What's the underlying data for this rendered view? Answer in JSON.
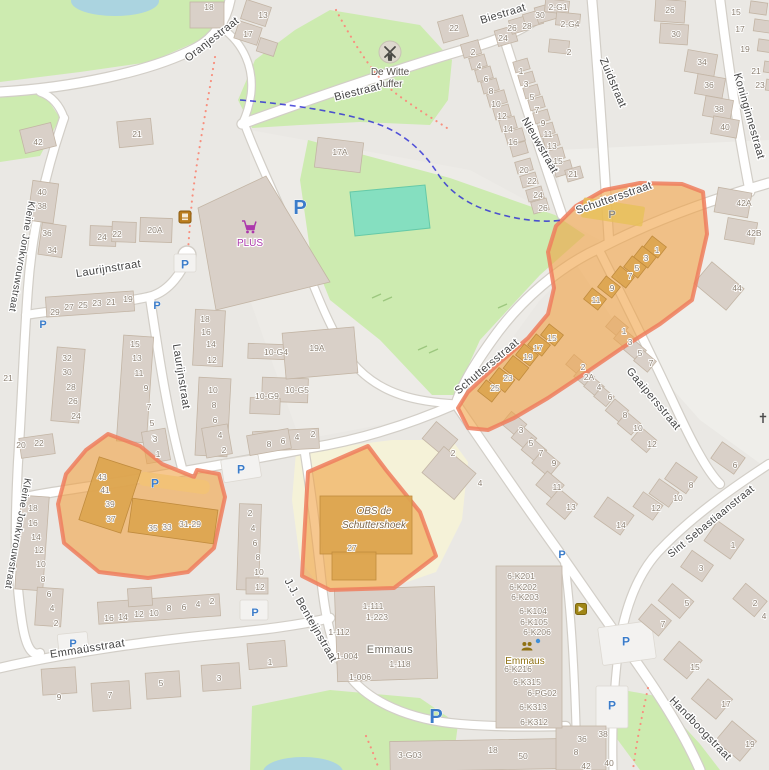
{
  "streets": [
    {
      "t": "Oranjestraat",
      "x": 214,
      "y": 42,
      "r": -38
    },
    {
      "t": "Biestraat",
      "x": 504,
      "y": 17,
      "r": -17
    },
    {
      "t": "Biestraat",
      "x": 358,
      "y": 95,
      "r": -14
    },
    {
      "t": "Nieuwstraat",
      "x": 537,
      "y": 147,
      "r": 60
    },
    {
      "t": "Zuidstraat",
      "x": 610,
      "y": 84,
      "r": 67
    },
    {
      "t": "Koninginnestraat",
      "x": 746,
      "y": 117,
      "r": 74
    },
    {
      "t": "Schuttersstraat",
      "x": 615,
      "y": 201,
      "r": -19
    },
    {
      "t": "Schuttersstraat",
      "x": 489,
      "y": 369,
      "r": -40
    },
    {
      "t": "Laurijnstraat",
      "x": 109,
      "y": 272,
      "r": -9
    },
    {
      "t": "Laurijnstraat",
      "x": 178,
      "y": 377,
      "r": 81
    },
    {
      "t": "Kleine Jonkvrouwstraat",
      "x": 19,
      "y": 256,
      "r": 100,
      "s": 10
    },
    {
      "t": "Kleine Jonkvrouwstraat",
      "x": 15,
      "y": 533,
      "r": 100,
      "s": 10
    },
    {
      "t": "Gaaipersstraat",
      "x": 651,
      "y": 401,
      "r": 50
    },
    {
      "t": "Sint Sebastiaanstraat",
      "x": 713,
      "y": 524,
      "r": -39,
      "s": 10.5
    },
    {
      "t": "Handboogstraat",
      "x": 698,
      "y": 731,
      "r": 46
    },
    {
      "t": "Emmaüsstraat",
      "x": 88,
      "y": 652,
      "r": -9
    },
    {
      "t": "J.J. Benteijnstraat",
      "x": 308,
      "y": 622,
      "r": 60
    }
  ],
  "pois": {
    "windmill": {
      "line1": "De Witte",
      "line2": "Juffer"
    },
    "supermarket": {
      "name": "PLUS"
    },
    "school": {
      "line1": "OBS de",
      "line2": "Schuttershoek"
    },
    "building_emmaus": {
      "name": "Emmaus"
    },
    "community_emmaus": {
      "name": "Emmaus"
    }
  },
  "parking_label": "P",
  "parking_markers": [
    [
      300,
      207,
      20
    ],
    [
      436,
      716,
      20
    ],
    [
      185,
      264,
      12
    ],
    [
      157,
      305,
      11
    ],
    [
      43,
      324,
      11
    ],
    [
      241,
      469,
      12
    ],
    [
      155,
      483,
      12
    ],
    [
      612,
      214,
      11,
      "gray"
    ],
    [
      562,
      554,
      11
    ],
    [
      626,
      641,
      12
    ],
    [
      612,
      705,
      12
    ],
    [
      73,
      643,
      11
    ],
    [
      255,
      612,
      11
    ]
  ],
  "house_numbers": [
    [
      "18",
      209,
      7
    ],
    [
      "13",
      263,
      15
    ],
    [
      "17",
      248,
      34
    ],
    [
      "21",
      137,
      134
    ],
    [
      "42",
      38,
      142
    ],
    [
      "22",
      454,
      28
    ],
    [
      "2",
      473,
      52
    ],
    [
      "4",
      479,
      66
    ],
    [
      "6",
      486,
      79
    ],
    [
      "8",
      491,
      91
    ],
    [
      "10",
      496,
      104
    ],
    [
      "12",
      502,
      116
    ],
    [
      "14",
      508,
      129
    ],
    [
      "16",
      513,
      142
    ],
    [
      "20",
      524,
      170
    ],
    [
      "22",
      532,
      181
    ],
    [
      "24",
      538,
      195
    ],
    [
      "26",
      543,
      208
    ],
    [
      "24",
      503,
      38
    ],
    [
      "26",
      512,
      28
    ],
    [
      "28",
      527,
      26
    ],
    [
      "30",
      540,
      15
    ],
    [
      "1",
      521,
      71
    ],
    [
      "3",
      526,
      84
    ],
    [
      "5",
      532,
      97
    ],
    [
      "7",
      537,
      110
    ],
    [
      "9",
      543,
      123
    ],
    [
      "11",
      548,
      134
    ],
    [
      "13",
      552,
      146
    ],
    [
      "15",
      558,
      161
    ],
    [
      "21",
      573,
      174
    ],
    [
      "2-G1",
      558,
      7
    ],
    [
      "2-G4",
      570,
      24
    ],
    [
      "2",
      569,
      52
    ],
    [
      "26",
      670,
      10
    ],
    [
      "30",
      676,
      34
    ],
    [
      "34",
      702,
      62
    ],
    [
      "36",
      709,
      85
    ],
    [
      "38",
      719,
      109
    ],
    [
      "40",
      725,
      127
    ],
    [
      "15",
      736,
      12
    ],
    [
      "17",
      740,
      29
    ],
    [
      "19",
      745,
      49
    ],
    [
      "21",
      756,
      71
    ],
    [
      "23",
      760,
      85
    ],
    [
      "42A",
      744,
      203
    ],
    [
      "42B",
      754,
      233
    ],
    [
      "44",
      737,
      288
    ],
    [
      "1",
      657,
      250
    ],
    [
      "3",
      646,
      258
    ],
    [
      "5",
      637,
      268
    ],
    [
      "7",
      630,
      276
    ],
    [
      "9",
      612,
      288
    ],
    [
      "11",
      596,
      300
    ],
    [
      "15",
      552,
      338
    ],
    [
      "17",
      538,
      348
    ],
    [
      "19",
      528,
      357
    ],
    [
      "23",
      508,
      378
    ],
    [
      "25",
      495,
      388
    ],
    [
      "1",
      624,
      331
    ],
    [
      "3",
      630,
      342
    ],
    [
      "5",
      640,
      353
    ],
    [
      "7",
      651,
      363
    ],
    [
      "2",
      583,
      367
    ],
    [
      "2A",
      589,
      377
    ],
    [
      "4",
      599,
      387
    ],
    [
      "6",
      610,
      397
    ],
    [
      "8",
      625,
      415
    ],
    [
      "10",
      638,
      428
    ],
    [
      "12",
      652,
      444
    ],
    [
      "8",
      691,
      485
    ],
    [
      "10",
      678,
      498
    ],
    [
      "12",
      656,
      508
    ],
    [
      "14",
      621,
      525
    ],
    [
      "6",
      735,
      465
    ],
    [
      "1",
      733,
      545
    ],
    [
      "3",
      701,
      568
    ],
    [
      "5",
      687,
      603
    ],
    [
      "7",
      663,
      624
    ],
    [
      "2",
      755,
      603
    ],
    [
      "4",
      764,
      616
    ],
    [
      "15",
      695,
      667
    ],
    [
      "17",
      726,
      704
    ],
    [
      "19",
      750,
      744
    ],
    [
      "36",
      582,
      739
    ],
    [
      "38",
      603,
      734
    ],
    [
      "40",
      609,
      763
    ],
    [
      "8",
      576,
      752
    ],
    [
      "42",
      586,
      766
    ],
    [
      "3",
      521,
      430
    ],
    [
      "5",
      531,
      443
    ],
    [
      "7",
      541,
      453
    ],
    [
      "9",
      554,
      463
    ],
    [
      "11",
      557,
      487
    ],
    [
      "13",
      571,
      507
    ],
    [
      "2",
      453,
      453
    ],
    [
      "4",
      480,
      483
    ],
    [
      "27",
      352,
      548
    ],
    [
      "40",
      42,
      192
    ],
    [
      "38",
      42,
      206
    ],
    [
      "36",
      47,
      233
    ],
    [
      "34",
      52,
      250
    ],
    [
      "24",
      102,
      237
    ],
    [
      "22",
      117,
      234
    ],
    [
      "20A",
      155,
      230
    ],
    [
      "29",
      55,
      312
    ],
    [
      "27",
      69,
      307
    ],
    [
      "25",
      83,
      305
    ],
    [
      "23",
      97,
      303
    ],
    [
      "21",
      111,
      302
    ],
    [
      "19",
      128,
      299
    ],
    [
      "32",
      67,
      358
    ],
    [
      "30",
      67,
      372
    ],
    [
      "28",
      71,
      387
    ],
    [
      "26",
      73,
      401
    ],
    [
      "24",
      76,
      416
    ],
    [
      "15",
      135,
      344
    ],
    [
      "13",
      137,
      358
    ],
    [
      "11",
      139,
      373
    ],
    [
      "9",
      146,
      388
    ],
    [
      "7",
      149,
      407
    ],
    [
      "5",
      152,
      423
    ],
    [
      "3",
      154,
      438
    ],
    [
      "18",
      205,
      319
    ],
    [
      "16",
      206,
      332
    ],
    [
      "14",
      211,
      344
    ],
    [
      "12",
      212,
      360
    ],
    [
      "10",
      213,
      390
    ],
    [
      "8",
      214,
      405
    ],
    [
      "6",
      215,
      420
    ],
    [
      "4",
      220,
      435
    ],
    [
      "2",
      224,
      450
    ],
    [
      "10-G4",
      276,
      352
    ],
    [
      "19A",
      317,
      348
    ],
    [
      "10-G5",
      297,
      390
    ],
    [
      "10-G9",
      267,
      396
    ],
    [
      "17A",
      340,
      152
    ],
    [
      "8",
      269,
      444
    ],
    [
      "6",
      283,
      441
    ],
    [
      "4",
      297,
      437
    ],
    [
      "2",
      313,
      434
    ],
    [
      "20",
      21,
      445
    ],
    [
      "22",
      39,
      443
    ],
    [
      "18",
      33,
      508
    ],
    [
      "16",
      33,
      523
    ],
    [
      "14",
      36,
      537
    ],
    [
      "12",
      39,
      550
    ],
    [
      "10",
      41,
      564
    ],
    [
      "8",
      43,
      579
    ],
    [
      "6",
      49,
      594
    ],
    [
      "4",
      52,
      608
    ],
    [
      "2",
      56,
      623
    ],
    [
      "21",
      8,
      378
    ],
    [
      "16",
      109,
      618
    ],
    [
      "14",
      123,
      617
    ],
    [
      "12",
      139,
      614
    ],
    [
      "10",
      154,
      613
    ],
    [
      "8",
      169,
      608
    ],
    [
      "6",
      184,
      607
    ],
    [
      "4",
      198,
      604
    ],
    [
      "2",
      212,
      601
    ],
    [
      "9",
      59,
      697
    ],
    [
      "7",
      110,
      695
    ],
    [
      "5",
      161,
      683
    ],
    [
      "3",
      219,
      678
    ],
    [
      "43",
      102,
      477
    ],
    [
      "41",
      105,
      490
    ],
    [
      "39",
      110,
      504
    ],
    [
      "37",
      111,
      519
    ],
    [
      "35",
      153,
      528
    ],
    [
      "33",
      167,
      527
    ],
    [
      "31-29",
      190,
      524
    ],
    [
      "3",
      155,
      439
    ],
    [
      "1",
      158,
      454
    ],
    [
      "2",
      250,
      513
    ],
    [
      "4",
      253,
      528
    ],
    [
      "6",
      255,
      543
    ],
    [
      "8",
      258,
      557
    ],
    [
      "10",
      259,
      572
    ],
    [
      "12",
      260,
      587
    ],
    [
      "1",
      270,
      662
    ],
    [
      "1-111",
      373,
      606
    ],
    [
      "1-223",
      377,
      617
    ],
    [
      "1-112",
      339,
      632
    ],
    [
      "1-004",
      347,
      656
    ],
    [
      "1-118",
      400,
      664
    ],
    [
      "1-006",
      360,
      677
    ],
    [
      "6-K201",
      521,
      576
    ],
    [
      "6-K202",
      523,
      587
    ],
    [
      "6-K203",
      525,
      597
    ],
    [
      "6-K104",
      533,
      611
    ],
    [
      "6-K105",
      534,
      622
    ],
    [
      "6-K206",
      537,
      632
    ],
    [
      "6-K216",
      518,
      669
    ],
    [
      "6-K315",
      527,
      682
    ],
    [
      "6-PG02",
      542,
      693
    ],
    [
      "6-K313",
      533,
      707
    ],
    [
      "6-K312",
      534,
      722
    ],
    [
      "3-G03",
      410,
      755
    ],
    [
      "18",
      493,
      750
    ],
    [
      "50",
      523,
      756
    ]
  ],
  "colors": {
    "land": "#eae8e4",
    "light_land": "#efeeea",
    "green": "#cdebb0",
    "pitch": "#85dfc0",
    "water": "#abd4e0",
    "school_area": "#f5f2d8",
    "road": "#ffffff",
    "road_casing": "#d2cec7",
    "building": "#d9d0c8",
    "building_line": "#c3b5a5",
    "highlight_fill": "#f0a245",
    "highlight_stroke": "#ee7e5e",
    "highlight_building": "#dca44e",
    "parking_blue": "#3b7cc9",
    "parking_gray": "#8d887b",
    "shop_purple": "#ac39ac",
    "footpath_red": "#f88f7e",
    "cycleway_blue": "#2a2ad4"
  }
}
